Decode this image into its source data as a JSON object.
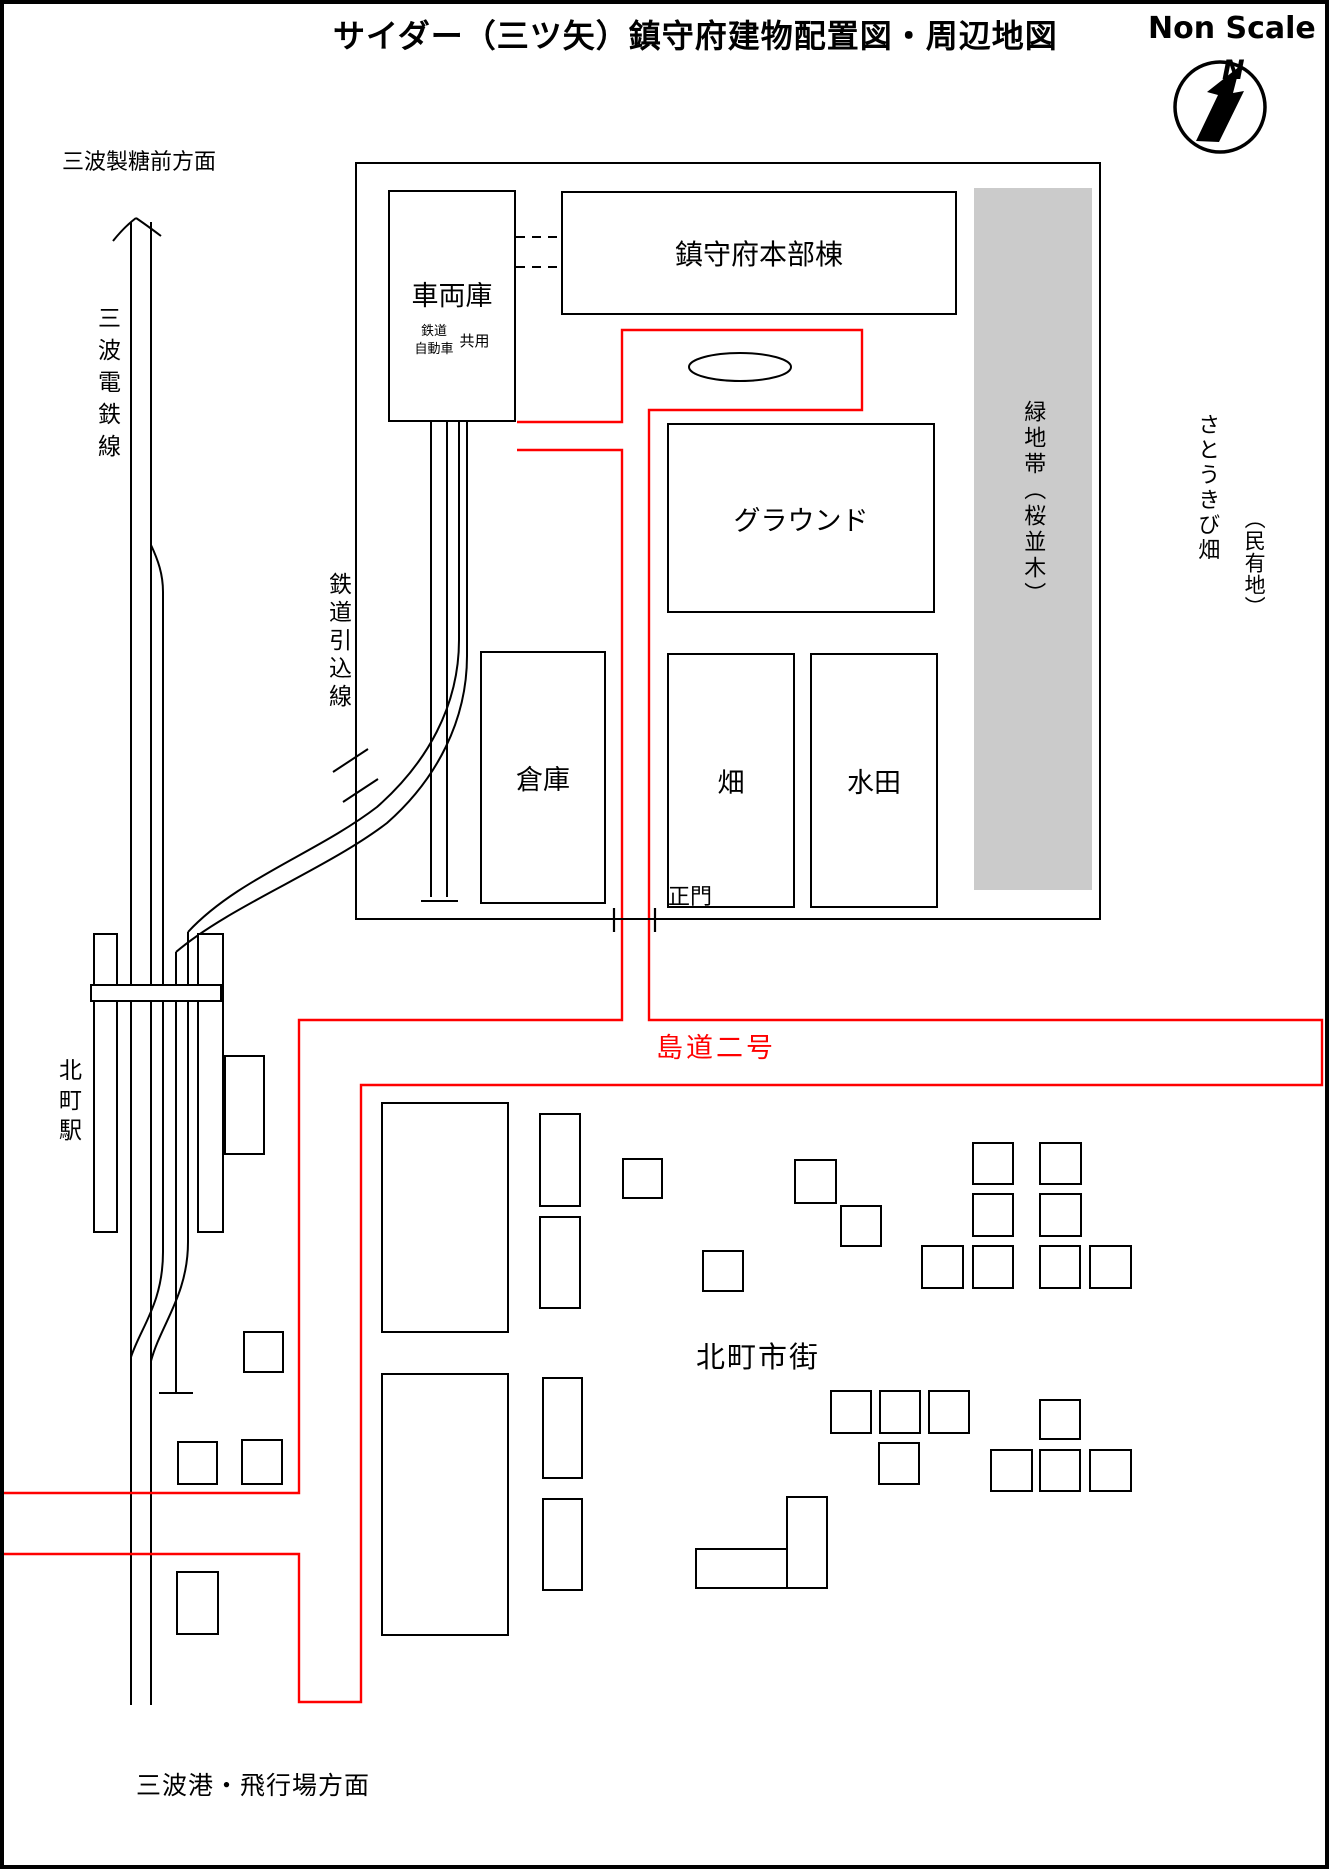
{
  "colors": {
    "road": "#ff0000",
    "greenbelt": "#cbcbcb",
    "ink": "#000000"
  },
  "header": {
    "title": "サイダー（三ツ矢）鎮守府建物配置図・周辺地図",
    "scale_note": "Non Scale",
    "compass_north": "N"
  },
  "compound": {
    "hq": "鎮守府本部棟",
    "depot": {
      "label": "車両庫",
      "sub_rail": "鉄道",
      "sub_car": "自動車",
      "sub_shared": "共用"
    },
    "ground": "グラウンド",
    "warehouse": "倉庫",
    "field": "畑",
    "paddy": "水田",
    "greenbelt": "緑地帯（桜並木）",
    "gate": "正門"
  },
  "surroundings": {
    "to_sugar_mill": "三波製糖前方面",
    "to_port": "三波港・飛行場方面",
    "railway": "三波電鉄線",
    "siding": "鉄道引込線",
    "station": "北町駅",
    "city": "北町市街",
    "road_name": "島道二号",
    "sugarcane": "さとうきび畑",
    "private_land": "（民有地）"
  }
}
